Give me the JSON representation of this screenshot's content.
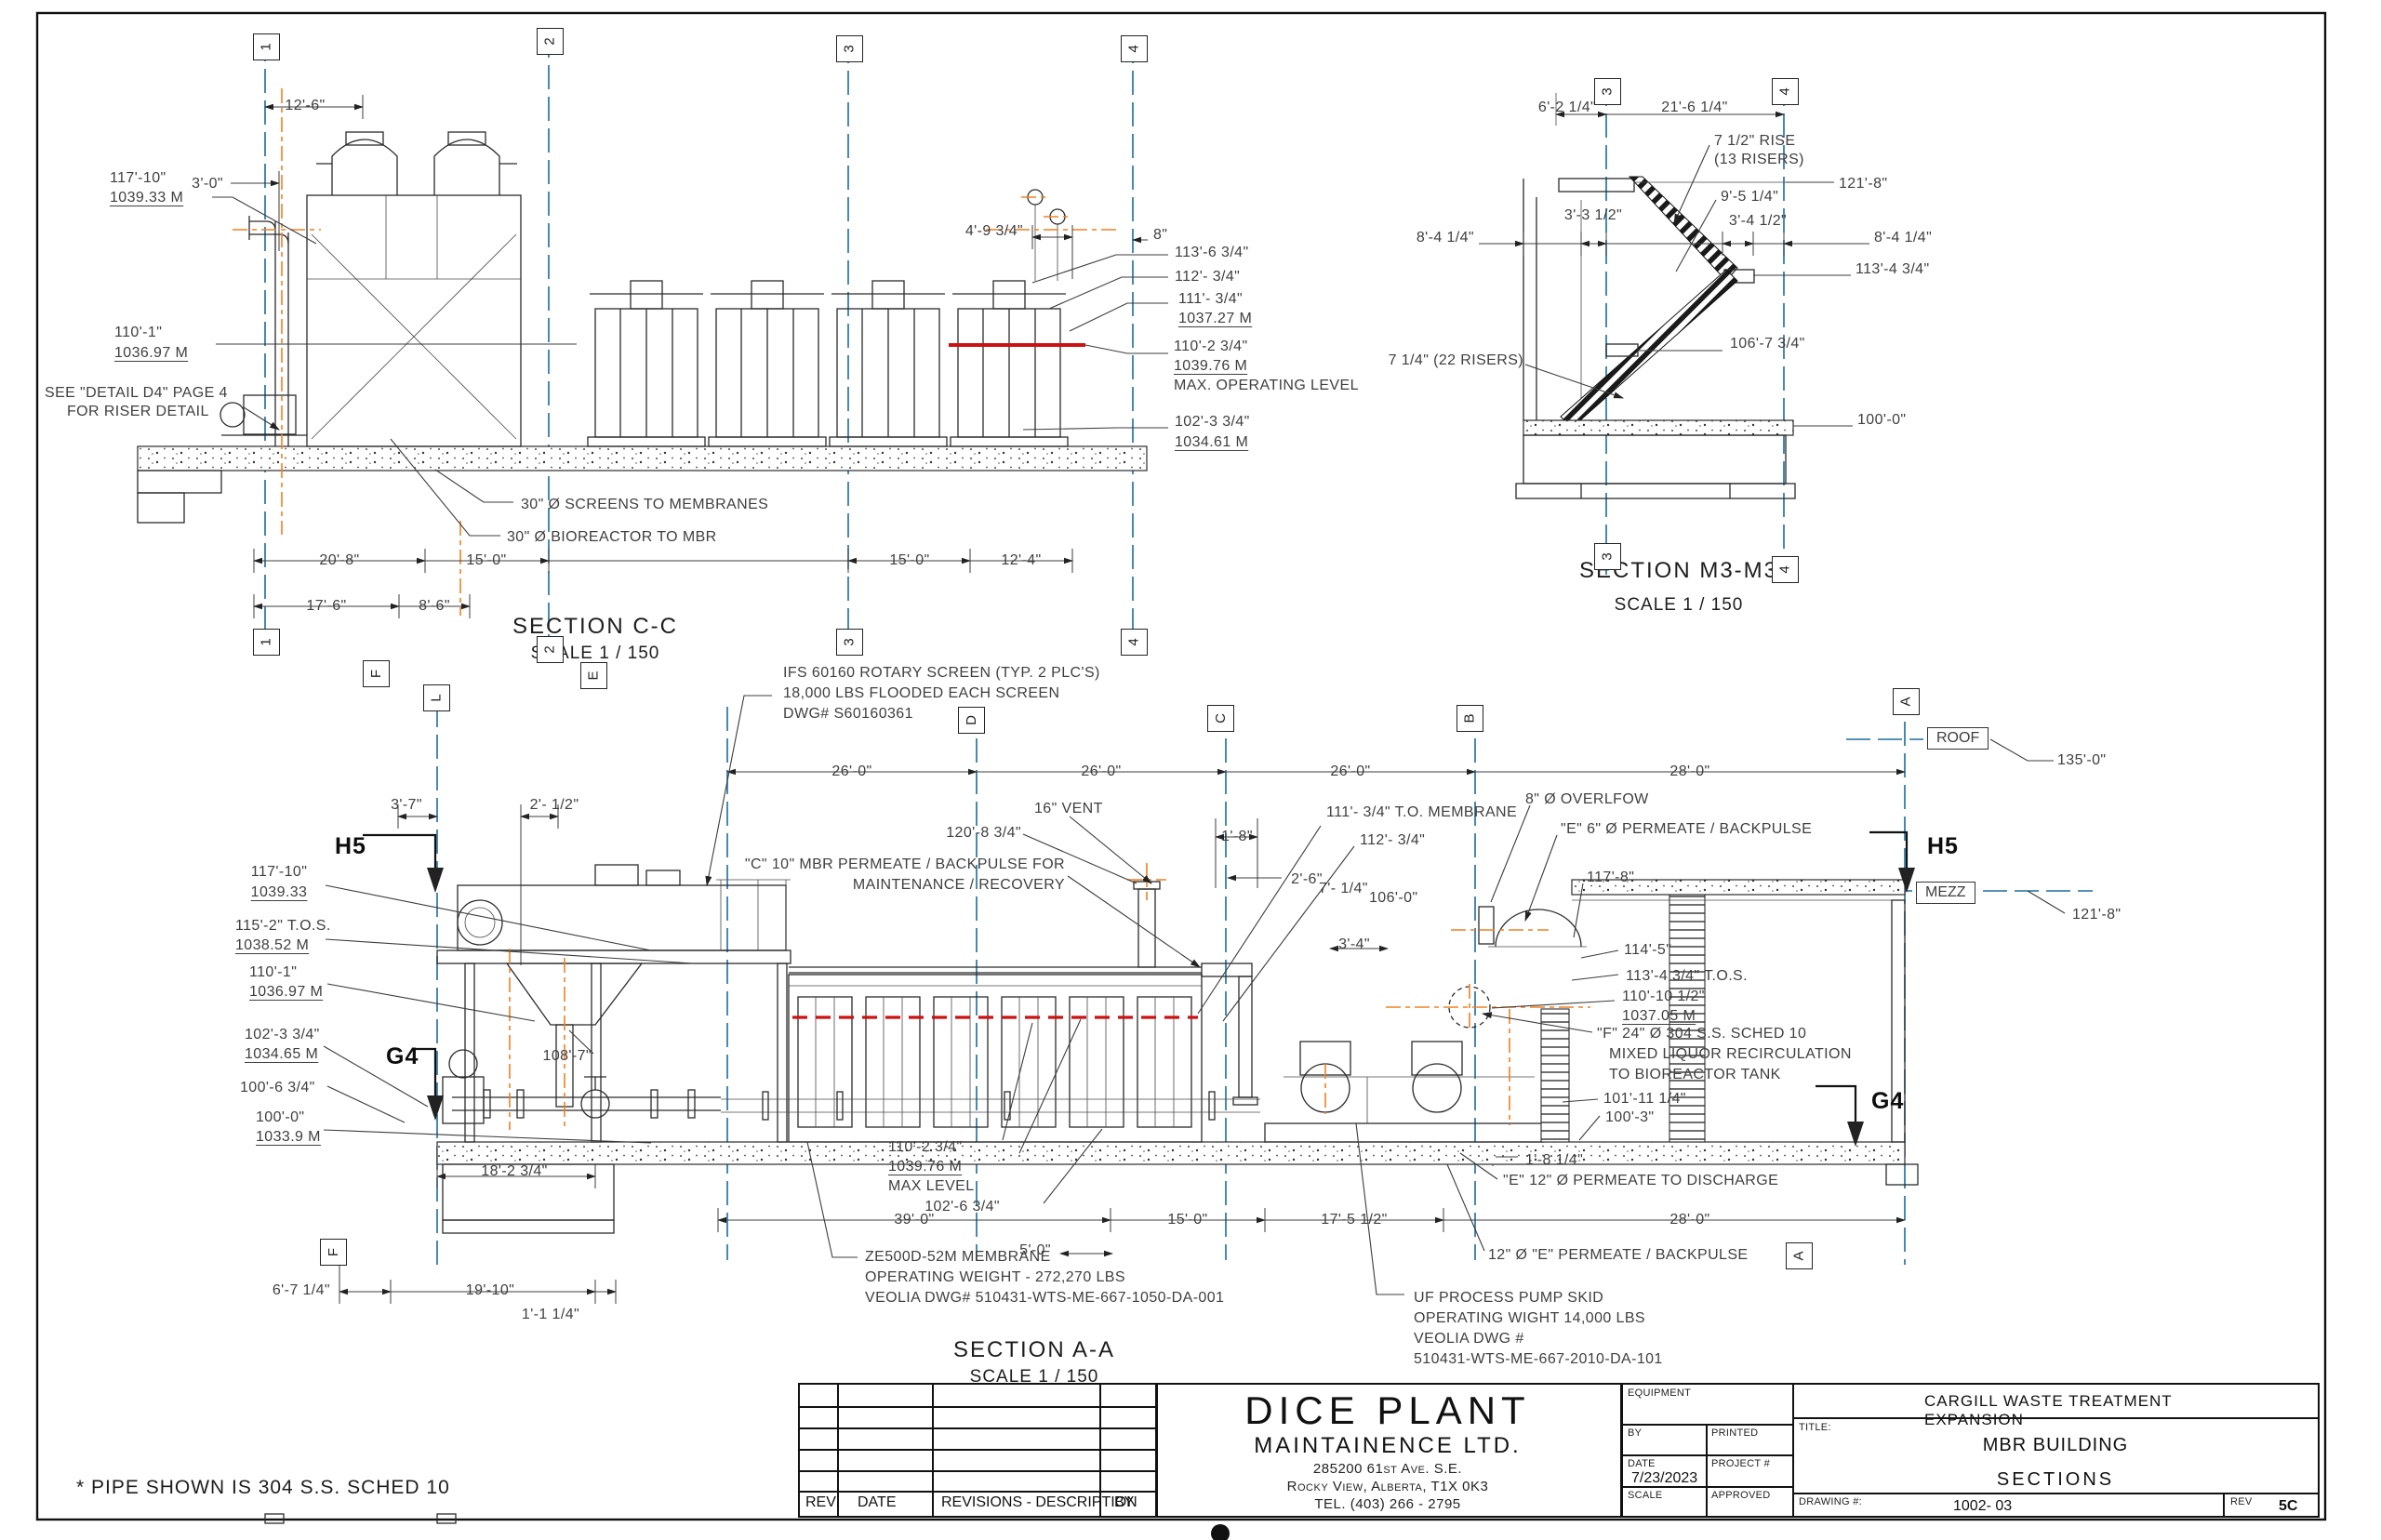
{
  "colors": {
    "grid_blue": "#1a6e9e",
    "centerline_orange": "#f08020",
    "max_level_red": "#cc1111"
  },
  "sheet_note": "* PIPE SHOWN IS 304 S.S. SCHED 10",
  "markers": {
    "h5": "H5",
    "g4": "G4"
  },
  "bubbles": {
    "cc_top": [
      "1",
      "2",
      "3",
      "4"
    ],
    "cc_bottom": [
      "1",
      "2",
      "3",
      "4"
    ],
    "cc_letters": [
      "F",
      "E"
    ],
    "m3_top": [
      "3",
      "4"
    ],
    "m3_bottom": [
      "3",
      "4"
    ],
    "aa_top": [
      "L",
      "D",
      "C",
      "B",
      "A"
    ],
    "aa_bottom": [
      "F",
      "A"
    ],
    "levels": {
      "roof": "ROOF",
      "mezz": "MEZZ"
    }
  },
  "cc": {
    "title": "SECTION C-C",
    "scale": "SCALE 1 / 150",
    "dim_12_6": "12'-6\"",
    "dim_3_0": "3'-0\"",
    "elev_117_ft": "117'-10\"",
    "elev_117_m": "1039.33 M",
    "elev_110_ft": "110'-1\"",
    "elev_110_m": "1036.97 M",
    "detail_note_1": "SEE \"DETAIL D4\" PAGE 4",
    "detail_note_2": "FOR RISER DETAIL",
    "dim_4_9": "4'-9 3/4\"",
    "dim_8": "8\"",
    "lvl_113_6": "113'-6 3/4\"",
    "lvl_112": "112'- 3/4\"",
    "lvl_111_ft": "111'- 3/4\"",
    "lvl_111_m": "1037.27 M",
    "lvl_110_2_ft": "110'-2 3/4\"",
    "lvl_110_2_m": "1039.76 M",
    "lvl_110_2_note": "MAX. OPERATING LEVEL",
    "lvl_102_ft": "102'-3 3/4\"",
    "lvl_102_m": "1034.61 M",
    "pipe_screens": "30\" Ø SCREENS TO MEMBRANES",
    "pipe_bioreactor": "30\" Ø BIOREACTOR TO MBR",
    "dim_20_8": "20'-8\"",
    "dim_15_0a": "15'-0\"",
    "dim_15_0b": "15'-0\"",
    "dim_12_4": "12'-4\"",
    "dim_17_6": "17'-6\"",
    "dim_8_6": "8'-6\""
  },
  "m3": {
    "title": "SECTION M3-M3",
    "scale": "SCALE 1 / 150",
    "dim_6_2": "6'-2 1/4\"",
    "dim_21_6": "21'-6 1/4\"",
    "rise_1": "7 1/2\" RISE",
    "rise_2": "(13 RISERS)",
    "dim_9_5": "9'-5 1/4\"",
    "lvl_121_8": "121'-8\"",
    "dim_3_3": "3'-3 1/2\"",
    "dim_3_4": "3'-4 1/2\"",
    "dim_8_4_l": "8'-4 1/4\"",
    "dim_8_4_r": "8'-4 1/4\"",
    "lvl_113_4": "113'-4 3/4\"",
    "risers_22": "7 1/4\" (22 RISERS)",
    "lvl_106_7": "106'-7 3/4\"",
    "lvl_100_0": "100'-0\""
  },
  "aa": {
    "title": "SECTION A-A",
    "scale": "SCALE 1 / 150",
    "ifs_1": "IFS 60160 ROTARY SCREEN (TYP. 2 PLC'S)",
    "ifs_2": "18,000 LBS FLOODED EACH SCREEN",
    "ifs_3": "DWG# S60160361",
    "dim_26_a": "26'-0\"",
    "dim_26_b": "26'-0\"",
    "dim_26_c": "26'-0\"",
    "dim_28_top": "28'-0\"",
    "lvl_roof": "135'-0\"",
    "lvl_mezz": "121'-8\"",
    "dim_3_7": "3'-7\"",
    "dim_2_half": "2'- 1/2\"",
    "elev_117_ft": "117'-10\"",
    "elev_117_m": "1039.33",
    "elev_115_ft": "115'-2\" T.O.S.",
    "elev_115_m": "1038.52 M",
    "elev_110_ft": "110'-1\"",
    "elev_110_m": "1036.97 M",
    "elev_102_ft": "102'-3 3/4\"",
    "elev_102_m": "1034.65 M",
    "elev_100_6": "100'-6 3/4\"",
    "elev_100_ft": "100'-0\"",
    "elev_100_m": "1033.9 M",
    "lvl_108_7": "108'-7\"",
    "dim_18_2": "18'-2 3/4\"",
    "c10_1": "\"C\" 10\" MBR PERMEATE / BACKPULSE FOR",
    "c10_2": "MAINTENANCE / RECOVERY",
    "vent": "16\" VENT",
    "lvl_120_8": "120'-8 3/4\"",
    "dim_1_8": "1'-8\"",
    "dim_2_6": "2'-6\"",
    "lvl_111_mem": "111'- 3/4\" T.O. MEMBRANE",
    "lvl_112": "112'- 3/4\"",
    "dim_7_quarter": "7'- 1/4\"",
    "lvl_106_0": "106'-0\"",
    "dim_3_4": "3'-4\"",
    "overflow": "8\" Ø OVERLFOW",
    "e6": "\"E\" 6\" Ø PERMEATE / BACKPULSE",
    "lvl_117_8": "117'-8\"",
    "lvl_114_5": "114'-5\"",
    "lvl_113_4": "113'-4 3/4\" T.O.S.",
    "lvl_110_10_ft": "110'-10 1/2\"",
    "lvl_110_10_m": "1037.05 M",
    "f24_1": "\"F\" 24\" Ø 304 S.S. SCHED 10",
    "f24_2": "MIXED LIQUOR RECIRCULATION",
    "f24_3": "TO BIOREACTOR TANK",
    "lvl_101_11": "101'-11 1/4\"",
    "lvl_100_3": "100'-3\"",
    "dim_1_8_quarter": "1'-8 1/4\"",
    "e12": "\"E\" 12\" Ø PERMEATE TO DISCHARGE",
    "e12b": "12\" Ø \"E\" PERMEATE / BACKPULSE",
    "max_ft": "110'-2 3/4\"",
    "max_m": "1039.76 M",
    "max_note": "MAX LEVEL",
    "lvl_102_6": "102'-6 3/4\"",
    "dim_39": "39'-0\"",
    "dim_15": "15'-0\"",
    "dim_5": "5'-0\"",
    "dim_17_5": "17'-5 1/2\"",
    "dim_28_bot": "28'-0\"",
    "dim_6_7": "6'-7 1/4\"",
    "dim_19_10": "19'-10\"",
    "dim_1_1": "1'-1 1/4\"",
    "ze_1": "ZE500D-52M MEMBRANE",
    "ze_2": "OPERATING WEIGHT - 272,270 LBS",
    "ze_3": "VEOLIA DWG# 510431-WTS-ME-667-1050-DA-001",
    "uf_1": "UF PROCESS PUMP SKID",
    "uf_2": "OPERATING WIGHT 14,000 LBS",
    "uf_3": "VEOLIA DWG #",
    "uf_4": "510431-WTS-ME-667-2010-DA-101"
  },
  "tb": {
    "rev": "REV",
    "date": "DATE",
    "desc": "REVISIONS - DESCRIPTION",
    "by": "BY",
    "company_1": "DICE PLANT",
    "company_2": "MAINTAINENCE LTD.",
    "addr_1": "285200 61st Ave. S.E.",
    "addr_2": "Rocky View, Alberta, T1X 0K3",
    "addr_3": "TEL. (403) 266 - 2795",
    "equipment": "EQUIPMENT",
    "by2": "BY",
    "printed": "PRINTED",
    "date2": "DATE",
    "date_val": "7/23/2023",
    "project": "PROJECT #",
    "scale": "SCALE",
    "approved": "APPROVED",
    "project_title": "CARGILL WASTE TREATMENT EXPANSION",
    "title_label": "TITLE:",
    "title_1": "MBR BUILDING",
    "title_2": "SECTIONS",
    "drawing_label": "DRAWING #:",
    "drawing_no": "1002- 03",
    "rev_label": "REV",
    "rev_val": "5C"
  }
}
